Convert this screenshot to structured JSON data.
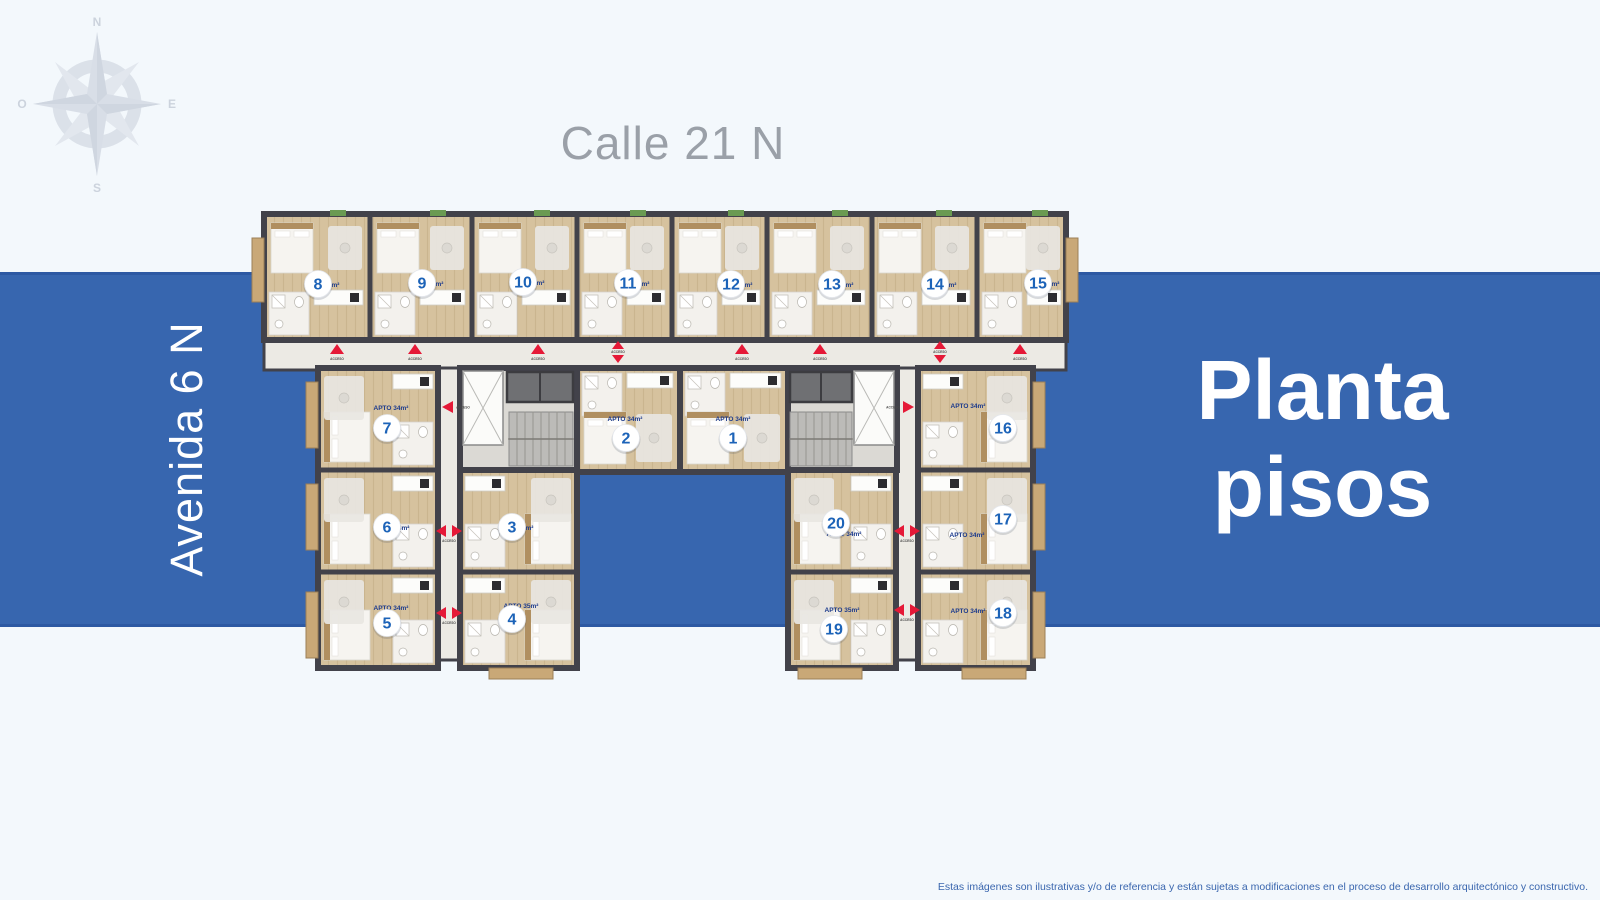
{
  "compass": {
    "n": "N",
    "s": "S",
    "e": "E",
    "o": "O"
  },
  "streets": {
    "top": "Calle 21 N",
    "left": "Avenida 6 N"
  },
  "title": {
    "line1": "Planta",
    "line2": "pisos"
  },
  "disclaimer": "Estas imágenes son ilustrativas y/o de referencia y están sujetas a modificaciones en el proceso de desarrollo arquitectónico y constructivo.",
  "colors": {
    "band_blue": "#3766af",
    "band_edge": "#2d59a3",
    "background": "#f3f8fc",
    "street_gray": "#9aa0a8",
    "wall": "#42424a",
    "floor_wood": "#d6c29e",
    "corridor": "#eceae4",
    "core": "#dbd9d4",
    "balcony": "#c9a877",
    "access_red": "#e51937",
    "badge_number_blue": "#1c63b8",
    "area_label_navy": "#1b3a8c"
  },
  "floorplan": {
    "access_label": "ACCESO",
    "units": [
      {
        "number": "1",
        "area_label": "APTO 34m²",
        "cx": 733,
        "cy": 438,
        "lx": 733,
        "ly": 421,
        "bbox": [
          680,
          368,
          108,
          104
        ],
        "bath": "top"
      },
      {
        "number": "2",
        "area_label": "APTO 34m²",
        "cx": 626,
        "cy": 438,
        "lx": 625,
        "ly": 421,
        "bbox": [
          577,
          368,
          103,
          104
        ],
        "bath": "top"
      },
      {
        "number": "3",
        "area_label": "APTO 34m²",
        "cx": 512,
        "cy": 527,
        "lx": 516,
        "ly": 530,
        "bbox": [
          460,
          470,
          117,
          102
        ],
        "bath": "left"
      },
      {
        "number": "4",
        "area_label": "APTO 35m²",
        "cx": 512,
        "cy": 619,
        "lx": 521,
        "ly": 608,
        "bbox": [
          460,
          572,
          117,
          96
        ],
        "bath": "left"
      },
      {
        "number": "5",
        "area_label": "APTO 34m²",
        "cx": 387,
        "cy": 623,
        "lx": 391,
        "ly": 610,
        "bbox": [
          318,
          572,
          120,
          96
        ],
        "bath": "right"
      },
      {
        "number": "6",
        "area_label": "APTO 34m²",
        "cx": 387,
        "cy": 527,
        "lx": 392,
        "ly": 530,
        "bbox": [
          318,
          470,
          120,
          102
        ],
        "bath": "right"
      },
      {
        "number": "7",
        "area_label": "APTO 34m²",
        "cx": 387,
        "cy": 428,
        "lx": 391,
        "ly": 410,
        "bbox": [
          318,
          368,
          120,
          102
        ],
        "bath": "right"
      },
      {
        "number": "8",
        "area_label": "APTO 35m²",
        "cx": 318,
        "cy": 284,
        "lx": 322,
        "ly": 287,
        "bbox": [
          264,
          214,
          106,
          126
        ],
        "bath": "bottom"
      },
      {
        "number": "9",
        "area_label": "APTO 35m²",
        "cx": 422,
        "cy": 283,
        "lx": 426,
        "ly": 286,
        "bbox": [
          370,
          214,
          102,
          126
        ],
        "bath": "bottom"
      },
      {
        "number": "10",
        "area_label": "APTO 34m²",
        "cx": 523,
        "cy": 282,
        "lx": 527,
        "ly": 285,
        "bbox": [
          472,
          214,
          105,
          126
        ],
        "bath": "bottom"
      },
      {
        "number": "11",
        "area_label": "APTO 35m²",
        "cx": 628,
        "cy": 283,
        "lx": 632,
        "ly": 286,
        "bbox": [
          577,
          214,
          95,
          126
        ],
        "bath": "bottom"
      },
      {
        "number": "12",
        "area_label": "APTO 35m²",
        "cx": 731,
        "cy": 284,
        "lx": 735,
        "ly": 287,
        "bbox": [
          672,
          214,
          95,
          126
        ],
        "bath": "bottom"
      },
      {
        "number": "13",
        "area_label": "APTO 35m²",
        "cx": 832,
        "cy": 284,
        "lx": 836,
        "ly": 287,
        "bbox": [
          767,
          214,
          105,
          126
        ],
        "bath": "bottom"
      },
      {
        "number": "14",
        "area_label": "APTO 35m²",
        "cx": 935,
        "cy": 284,
        "lx": 939,
        "ly": 287,
        "bbox": [
          872,
          214,
          105,
          126
        ],
        "bath": "bottom"
      },
      {
        "number": "15",
        "area_label": "APTO 35m²",
        "cx": 1038,
        "cy": 283,
        "lx": 1042,
        "ly": 286,
        "bbox": [
          977,
          214,
          91,
          126
        ],
        "bath": "bottom"
      },
      {
        "number": "16",
        "area_label": "APTO 34m²",
        "cx": 1003,
        "cy": 428,
        "lx": 968,
        "ly": 408,
        "bbox": [
          918,
          368,
          115,
          102
        ],
        "bath": "left"
      },
      {
        "number": "17",
        "area_label": "APTO 34m²",
        "cx": 1003,
        "cy": 519,
        "lx": 967,
        "ly": 537,
        "bbox": [
          918,
          470,
          115,
          102
        ],
        "bath": "left"
      },
      {
        "number": "18",
        "area_label": "APTO 34m²",
        "cx": 1003,
        "cy": 613,
        "lx": 968,
        "ly": 613,
        "bbox": [
          918,
          572,
          115,
          96
        ],
        "bath": "left"
      },
      {
        "number": "19",
        "area_label": "APTO 35m²",
        "cx": 834,
        "cy": 629,
        "lx": 842,
        "ly": 612,
        "bbox": [
          788,
          572,
          108,
          96
        ],
        "bath": "right"
      },
      {
        "number": "20",
        "area_label": "APTO 34m²",
        "cx": 836,
        "cy": 523,
        "lx": 844,
        "ly": 536,
        "bbox": [
          788,
          470,
          108,
          102
        ],
        "bath": "right"
      }
    ],
    "markers": [
      {
        "type": "up",
        "x": 337,
        "y": 349
      },
      {
        "type": "up",
        "x": 415,
        "y": 349
      },
      {
        "type": "up",
        "x": 538,
        "y": 349
      },
      {
        "type": "updown",
        "x": 618,
        "y": 352
      },
      {
        "type": "up",
        "x": 742,
        "y": 349
      },
      {
        "type": "up",
        "x": 820,
        "y": 349
      },
      {
        "type": "updown",
        "x": 940,
        "y": 352
      },
      {
        "type": "up",
        "x": 1020,
        "y": 349
      },
      {
        "type": "left",
        "x": 448,
        "y": 407
      },
      {
        "type": "right",
        "x": 908,
        "y": 407
      },
      {
        "type": "leftright",
        "x": 449,
        "y": 531
      },
      {
        "type": "leftright",
        "x": 449,
        "y": 613
      },
      {
        "type": "leftright",
        "x": 907,
        "y": 531
      },
      {
        "type": "leftright",
        "x": 907,
        "y": 610
      }
    ]
  }
}
